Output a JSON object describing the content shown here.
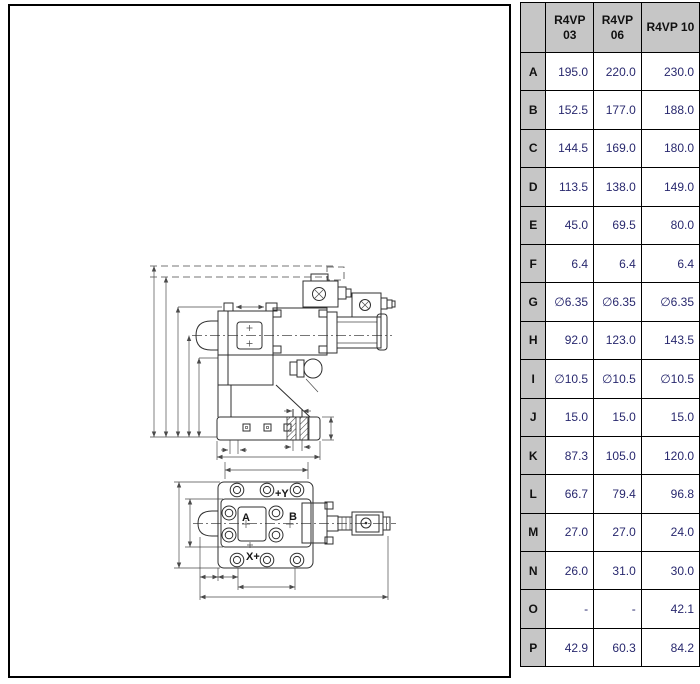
{
  "window": {
    "background": "#ffffff"
  },
  "table": {
    "columns": [
      "R4VP 03",
      "R4VP 06",
      "R4VP 10"
    ],
    "rows": [
      {
        "label": "A",
        "values": [
          "195.0",
          "220.0",
          "230.0"
        ]
      },
      {
        "label": "B",
        "values": [
          "152.5",
          "177.0",
          "188.0"
        ]
      },
      {
        "label": "C",
        "values": [
          "144.5",
          "169.0",
          "180.0"
        ]
      },
      {
        "label": "D",
        "values": [
          "113.5",
          "138.0",
          "149.0"
        ]
      },
      {
        "label": "E",
        "values": [
          "45.0",
          "69.5",
          "80.0"
        ]
      },
      {
        "label": "F",
        "values": [
          "6.4",
          "6.4",
          "6.4"
        ]
      },
      {
        "label": "G",
        "values": [
          "∅6.35",
          "∅6.35",
          "∅6.35"
        ]
      },
      {
        "label": "H",
        "values": [
          "92.0",
          "123.0",
          "143.5"
        ]
      },
      {
        "label": "I",
        "values": [
          "∅10.5",
          "∅10.5",
          "∅10.5"
        ]
      },
      {
        "label": "J",
        "values": [
          "15.0",
          "15.0",
          "15.0"
        ]
      },
      {
        "label": "K",
        "values": [
          "87.3",
          "105.0",
          "120.0"
        ]
      },
      {
        "label": "L",
        "values": [
          "66.7",
          "79.4",
          "96.8"
        ]
      },
      {
        "label": "M",
        "values": [
          "27.0",
          "27.0",
          "24.0"
        ]
      },
      {
        "label": "N",
        "values": [
          "26.0",
          "31.0",
          "30.0"
        ]
      },
      {
        "label": "O",
        "values": [
          "-",
          "-",
          "42.1"
        ]
      },
      {
        "label": "P",
        "values": [
          "42.9",
          "60.3",
          "84.2"
        ]
      }
    ],
    "colors": {
      "header_bg": "#c6c6c6",
      "value_text": "#28286e",
      "border": "#000000"
    }
  },
  "drawing": {
    "labels": {
      "port_a": "A",
      "port_b": "B",
      "axis_y": "+Y",
      "axis_x": "X+"
    }
  }
}
